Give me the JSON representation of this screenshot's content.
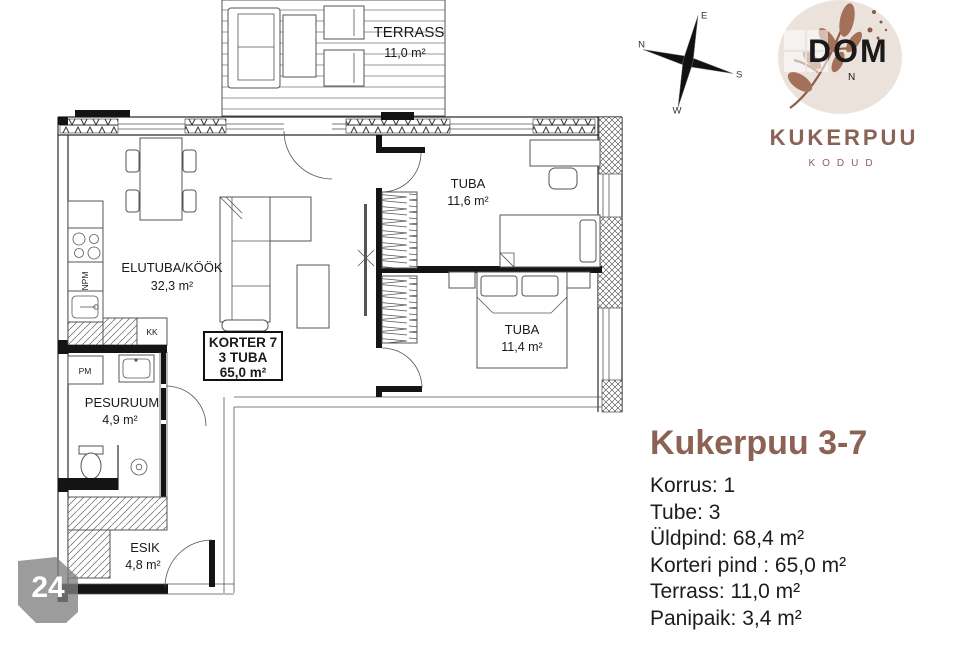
{
  "branding": {
    "logo_title": "KUKERPUU",
    "logo_subtitle": "KODUD",
    "watermark": "DOM",
    "brand_brown": "#8b6254",
    "logo_circle": "#ece2dc",
    "leaf_brown": "#a5705a"
  },
  "compass": {
    "north": "N",
    "east": "E",
    "south": "S",
    "west": "W"
  },
  "listing": {
    "title": "Kukerpuu 3-7",
    "details": [
      "Korrus: 1",
      "Tube: 3",
      "Üldpind: 68,4 m²",
      "Korteri pind : 65,0 m²",
      "Terrass: 11,0 m²",
      "Panipaik: 3,4 m²"
    ]
  },
  "page_number": "24",
  "floorplan": {
    "rooms": {
      "terrass": {
        "name": "TERRASS",
        "area": "11,0 m²"
      },
      "elutuba": {
        "name": "ELUTUBA/KÖÖK",
        "area": "32,3 m²"
      },
      "tuba_a": {
        "name": "TUBA",
        "area": "11,6 m²"
      },
      "tuba_b": {
        "name": "TUBA",
        "area": "11,4 m²"
      },
      "pesuruum": {
        "name": "PESURUUM",
        "area": "4,9 m²"
      },
      "esik": {
        "name": "ESIK",
        "area": "4,8 m²"
      }
    },
    "unit_box": {
      "line1": "KORTER 7",
      "line2": "3 TUBA",
      "line3": "65,0 m²"
    },
    "appliances": {
      "npm": "NPM",
      "kk": "KK",
      "pm": "PM"
    }
  }
}
